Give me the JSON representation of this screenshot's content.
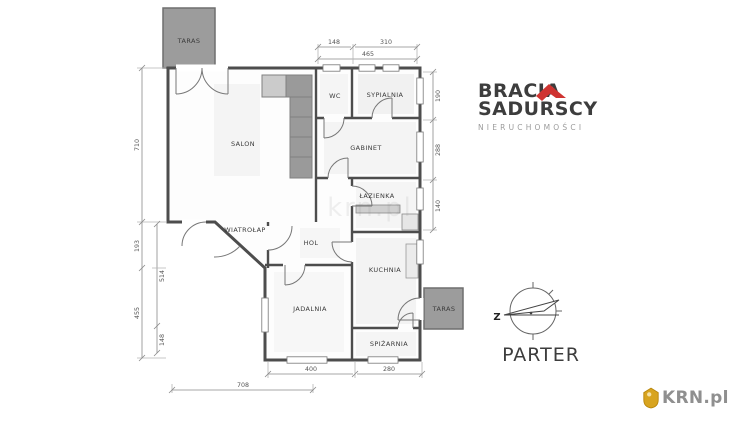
{
  "branding": {
    "line1": "BRACIA",
    "line2": "SADURSCY",
    "line3": "NIERUCHOMOŚCI"
  },
  "floor_label": "PARTER",
  "compass": {
    "west": "Z"
  },
  "krn": {
    "label": "KRN.pl"
  },
  "plan_watermark": "krn.pl",
  "rooms": [
    {
      "name": "taras-top",
      "label": "TARAS"
    },
    {
      "name": "salon",
      "label": "SALON"
    },
    {
      "name": "wc",
      "label": "WC"
    },
    {
      "name": "sypialnia",
      "label": "SYPIALNIA"
    },
    {
      "name": "gabinet",
      "label": "GABINET"
    },
    {
      "name": "lazienka",
      "label": "ŁAZIENKA"
    },
    {
      "name": "wiatrolap",
      "label": "WIATROŁAP"
    },
    {
      "name": "hol",
      "label": "HOL"
    },
    {
      "name": "kuchnia",
      "label": "KUCHNIA"
    },
    {
      "name": "jadalnia",
      "label": "JADALNIA"
    },
    {
      "name": "spizarnia",
      "label": "SPIŻARNIA"
    },
    {
      "name": "taras-right",
      "label": "TARAS"
    }
  ],
  "dims": {
    "top": [
      "148",
      "310",
      "465"
    ],
    "right": [
      "190",
      "288",
      "140"
    ],
    "left_outer": [
      "710",
      "193",
      "455"
    ],
    "left_inner": [
      "514",
      "148"
    ],
    "bottom": [
      "400",
      "280",
      "708"
    ]
  },
  "colors": {
    "wall": "#4d4d4d",
    "terrace": "#9c9c9c",
    "stairs": "#9a9a9a",
    "accent_red": "#cf3431",
    "krn_gold": "#d8a41f",
    "text_dark": "#3d3d3d",
    "text_gray": "#9b9b9b"
  }
}
